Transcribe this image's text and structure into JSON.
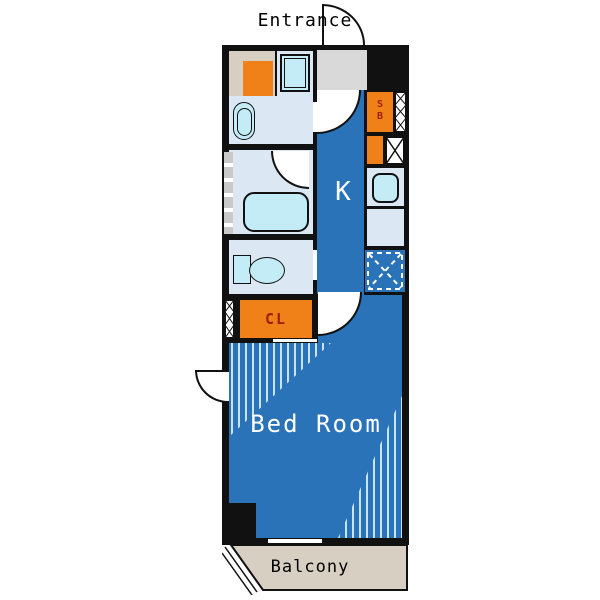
{
  "labels": {
    "entrance": "Entrance",
    "kitchen": "K",
    "shoe_box_top": "S",
    "shoe_box_bottom": "B",
    "closet": "CL",
    "bedroom": "Bed Room",
    "balcony": "Balcony"
  },
  "colors": {
    "wall": "#111111",
    "room_blue": "#2a73b8",
    "light_blue": "#dbe8f4",
    "fixture_cyan": "#c3ecf6",
    "orange": "#f08119",
    "label_red": "#9b1f00",
    "beige": "#d7cfc2",
    "entrance_gray": "#d9d9d9",
    "hatch_line": "#c8e5f8",
    "window_gray": "#c9c9c9"
  }
}
